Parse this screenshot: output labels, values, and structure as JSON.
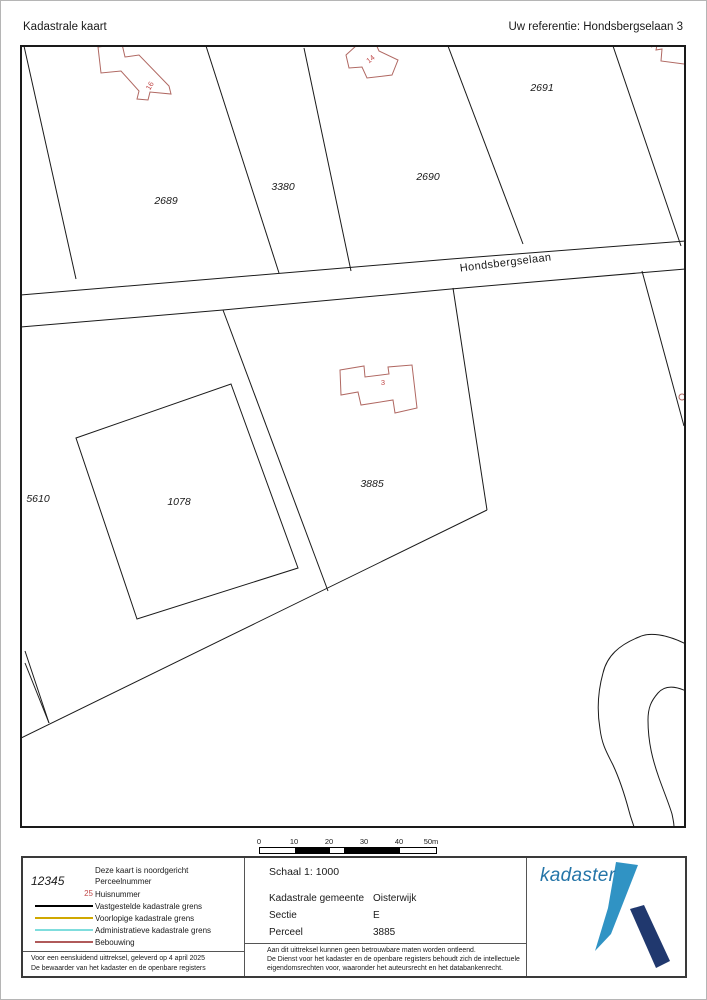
{
  "header": {
    "title": "Kadastrale kaart",
    "reference": "Uw referentie: Hondsbergselaan 3"
  },
  "map": {
    "street_label": "Hondsbergselaan",
    "parcels": {
      "p2689": "2689",
      "p3380": "3380",
      "p2690": "2690",
      "p2691": "2691",
      "p3885": "3885",
      "p1078": "1078",
      "p5610": "5610"
    },
    "house_numbers": {
      "h16": "16",
      "h14": "14",
      "h3": "3"
    },
    "colors": {
      "boundary": "#1a1a1a",
      "building": "#b06862",
      "house_number": "#c14a4a"
    }
  },
  "scalebar": {
    "ticks": [
      "0",
      "10",
      "20",
      "30",
      "40",
      "50m"
    ]
  },
  "footer": {
    "legend": {
      "north_note": "Deze kaart is noordgericht",
      "parcel_sample": "12345",
      "parcel_label": "Perceelnummer",
      "house_sample": "25",
      "house_label": "Huisnummer",
      "items": [
        {
          "label": "Vastgestelde kadastrale grens",
          "color": "#000000"
        },
        {
          "label": "Voorlopige kadastrale grens",
          "color": "#d0a800"
        },
        {
          "label": "Administratieve kadastrale grens",
          "color": "#7fdddd"
        },
        {
          "label": "Bebouwing",
          "color": "#b05a5a"
        }
      ],
      "certify_line1": "Voor een eensluidend uittreksel, geleverd op 4 april 2025",
      "certify_line2": "De bewaarder van het kadaster en de openbare registers"
    },
    "details": {
      "scale_label": "Schaal 1: 1000",
      "rows": [
        {
          "label": "Kadastrale gemeente",
          "value": "Oisterwijk"
        },
        {
          "label": "Sectie",
          "value": "E"
        },
        {
          "label": "Perceel",
          "value": "3885"
        }
      ],
      "disclaimer1": "Aan dit uittreksel kunnen geen betrouwbare maten worden ontleend.",
      "disclaimer2": "De Dienst voor het kadaster en de openbare registers behoudt zich de intellectuele",
      "disclaimer3": "eigendomsrechten voor, waaronder het auteursrecht en het databankenrecht."
    },
    "logo": {
      "wordmark": "kadaster",
      "text_color": "#2575a8",
      "light_color": "#3093c4",
      "dark_color": "#20386e"
    }
  }
}
